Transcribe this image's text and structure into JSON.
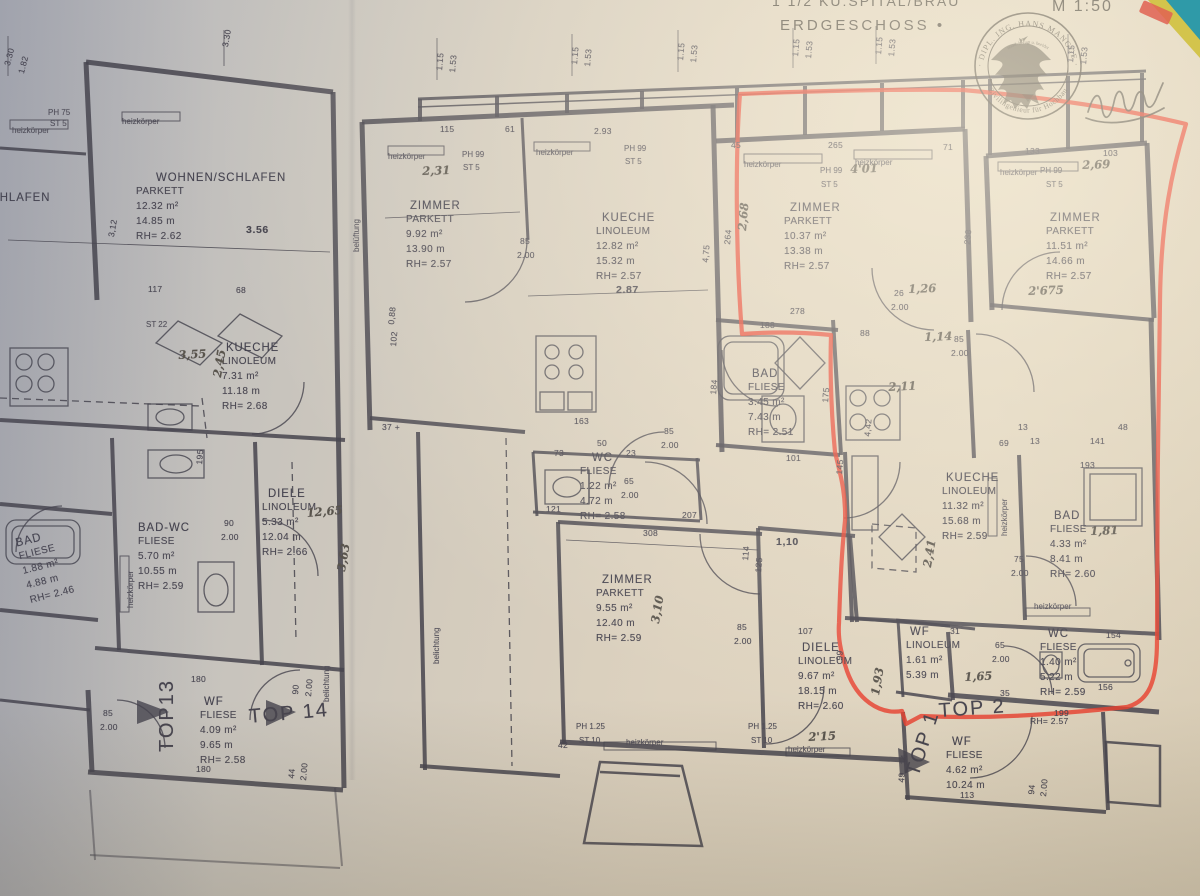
{
  "paper": {
    "background": "#d8cec0",
    "line_color": "#46444e",
    "pencil_color": "#59544c",
    "marker_color": "#e8402e"
  },
  "header": {
    "project_line": "1 1/2 KU:SPITAL/BRAU",
    "floor_line": "ERDGESCHOSS •",
    "scale": "M 1:50"
  },
  "stamp": {
    "arc_top": "· DIPL. ING. HANS MANGGE ·",
    "arc_inner": "staatl. befugt u. beeidet",
    "arc_bottom": "Zivilingenieur für Hochbau"
  },
  "rooms": [
    {
      "name": "WOHNEN/SCHLAFEN",
      "flooring": "PARKETT",
      "area": "12.32 m²",
      "perimeter": "14.85 m",
      "height": "RH= 2.62",
      "x": 136,
      "y": 170,
      "dx": 20
    },
    {
      "name": "SCHLAFEN",
      "x": -18,
      "y": 190
    },
    {
      "name": "ZIMMER",
      "flooring": "PARKETT",
      "area": "9.92 m²",
      "perimeter": "13.90 m",
      "height": "RH= 2.57",
      "x": 406,
      "y": 198,
      "dx": 4
    },
    {
      "name": "KUECHE",
      "flooring": "LINOLEUM",
      "area": "12.82 m²",
      "perimeter": "15.32 m",
      "height": "RH= 2.57",
      "x": 596,
      "y": 210,
      "dx": 6
    },
    {
      "name": "ZIMMER",
      "flooring": "PARKETT",
      "area": "10.37 m²",
      "perimeter": "13.38 m",
      "height": "RH= 2.57",
      "x": 784,
      "y": 200,
      "dx": 6
    },
    {
      "name": "ZIMMER",
      "flooring": "PARKETT",
      "area": "11.51 m²",
      "perimeter": "14.66 m",
      "height": "RH= 2.57",
      "x": 1046,
      "y": 210,
      "dx": 4
    },
    {
      "name": "KUECHE",
      "flooring": "LINOLEUM",
      "area": "7.31 m²",
      "perimeter": "11.18 m",
      "height": "RH= 2.68",
      "x": 222,
      "y": 340,
      "dx": 4
    },
    {
      "name": "BAD-WC",
      "flooring": "FLIESE",
      "area": "5.70 m²",
      "perimeter": "10.55 m",
      "height": "RH= 2.59",
      "x": 138,
      "y": 520
    },
    {
      "name": "DIELE",
      "flooring": "LINOLEUM",
      "area": "5.33 m²",
      "perimeter": "12.04 m",
      "height": "RH= 2.66",
      "x": 262,
      "y": 486,
      "dx": 6
    },
    {
      "name": "BAD",
      "flooring": "FLIESE",
      "area": "1.88 m²",
      "perimeter": "4.88 m",
      "height": "RH= 2.46",
      "x": 14,
      "y": 536,
      "rot": -14
    },
    {
      "name": "WC",
      "flooring": "FLIESE",
      "area": "1.22 m²",
      "perimeter": "4.72 m",
      "height": "RH= 2.58",
      "x": 580,
      "y": 450,
      "dx": 12
    },
    {
      "name": "ZIMMER",
      "flooring": "PARKETT",
      "area": "9.55 m²",
      "perimeter": "12.40 m",
      "height": "RH= 2.59",
      "x": 596,
      "y": 572,
      "dx": 6
    },
    {
      "name": "BAD",
      "flooring": "FLIESE",
      "area": "3.45 m²",
      "perimeter": "7.43 m",
      "height": "RH= 2.51",
      "x": 748,
      "y": 366,
      "dx": 4
    },
    {
      "name": "KUECHE",
      "flooring": "LINOLEUM",
      "area": "11.32 m²",
      "perimeter": "15.68 m",
      "height": "RH= 2.59",
      "x": 942,
      "y": 470,
      "dx": 4
    },
    {
      "name": "BAD",
      "flooring": "FLIESE",
      "area": "4.33 m²",
      "perimeter": "8.41 m",
      "height": "RH= 2.60",
      "x": 1050,
      "y": 508,
      "dx": 4
    },
    {
      "name": "WC",
      "flooring": "FLIESE",
      "area": "1.40 m²",
      "perimeter": "5.22 m",
      "height": "RH= 2.59",
      "x": 1040,
      "y": 626,
      "dx": 8
    },
    {
      "name": "DIELE",
      "flooring": "LINOLEUM",
      "area": "9.67 m²",
      "perimeter": "18.15 m",
      "height": "RH= 2.60",
      "x": 798,
      "y": 640,
      "dx": 4
    },
    {
      "name": "WF",
      "flooring": "LINOLEUM",
      "area": "1.61 m²",
      "perimeter": "5.39 m",
      "x": 906,
      "y": 624,
      "dx": 4
    },
    {
      "name": "WF",
      "flooring": "FLIESE",
      "area": "4.09 m²",
      "perimeter": "9.65 m",
      "height": "RH= 2.58",
      "x": 200,
      "y": 694,
      "dx": 4
    },
    {
      "name": "WF",
      "flooring": "FLIESE",
      "area": "4.62 m²",
      "perimeter": "10.24 m",
      "x": 946,
      "y": 734,
      "dx": 6
    }
  ],
  "tops": [
    {
      "t": "TOP13",
      "x": 156,
      "y": 752,
      "r": -90
    },
    {
      "t": "TOP 14",
      "x": 248,
      "y": 706,
      "r": -5
    },
    {
      "t": "TOP 1",
      "x": 902,
      "y": 772,
      "r": -72
    },
    {
      "t": "TOP 2",
      "x": 938,
      "y": 700,
      "r": -4
    }
  ],
  "notes": [
    {
      "t": "4'01",
      "x": 850,
      "y": 162,
      "r": -2
    },
    {
      "t": "2,69",
      "x": 1082,
      "y": 158,
      "r": -2
    },
    {
      "t": "2'675",
      "x": 1028,
      "y": 284,
      "r": -2
    },
    {
      "t": "2,68",
      "x": 735,
      "y": 230,
      "r": -85
    },
    {
      "t": "3,55",
      "x": 178,
      "y": 348,
      "r": -3
    },
    {
      "t": "2,45",
      "x": 210,
      "y": 376,
      "r": -80
    },
    {
      "t": "12,65",
      "x": 306,
      "y": 506,
      "r": -5
    },
    {
      "t": "3,63",
      "x": 334,
      "y": 570,
      "r": -80
    },
    {
      "t": "2,11",
      "x": 888,
      "y": 380,
      "r": -3
    },
    {
      "t": "2,41",
      "x": 920,
      "y": 566,
      "r": -80
    },
    {
      "t": "1,81",
      "x": 1090,
      "y": 524,
      "r": -2
    },
    {
      "t": "1,65",
      "x": 964,
      "y": 670,
      "r": -3
    },
    {
      "t": "1,93",
      "x": 868,
      "y": 694,
      "r": -80
    },
    {
      "t": "3,10",
      "x": 648,
      "y": 622,
      "r": -80
    },
    {
      "t": "2'15",
      "x": 808,
      "y": 730,
      "r": -3
    },
    {
      "t": "1,26",
      "x": 908,
      "y": 282,
      "r": -2
    },
    {
      "t": "1,14",
      "x": 924,
      "y": 330,
      "r": -2
    },
    {
      "t": "2,31",
      "x": 422,
      "y": 164,
      "r": -2
    }
  ],
  "dims": [
    {
      "t": "3.30",
      "x": 2,
      "y": 64,
      "r": -75
    },
    {
      "t": "1.82",
      "x": 16,
      "y": 72,
      "r": -75
    },
    {
      "t": "3.30",
      "x": 220,
      "y": 46,
      "r": -80
    },
    {
      "t": "1.15",
      "x": 434,
      "y": 70,
      "r": -85
    },
    {
      "t": "1.53",
      "x": 447,
      "y": 72,
      "r": -85
    },
    {
      "t": "1.15",
      "x": 569,
      "y": 64,
      "r": -85
    },
    {
      "t": "1.53",
      "x": 582,
      "y": 66,
      "r": -85
    },
    {
      "t": "1.15",
      "x": 675,
      "y": 60,
      "r": -85
    },
    {
      "t": "1.53",
      "x": 688,
      "y": 62,
      "r": -85
    },
    {
      "t": "1.15",
      "x": 790,
      "y": 56,
      "r": -85
    },
    {
      "t": "1.53",
      "x": 803,
      "y": 58,
      "r": -85
    },
    {
      "t": "1.15",
      "x": 873,
      "y": 54,
      "r": -85
    },
    {
      "t": "1.53",
      "x": 886,
      "y": 56,
      "r": -85
    },
    {
      "t": "1.15",
      "x": 1065,
      "y": 62,
      "r": -85
    },
    {
      "t": "1.53",
      "x": 1078,
      "y": 64,
      "r": -85
    },
    {
      "t": "115",
      "x": 440,
      "y": 124
    },
    {
      "t": "61",
      "x": 505,
      "y": 124
    },
    {
      "t": "2.93",
      "x": 594,
      "y": 126
    },
    {
      "t": "45",
      "x": 731,
      "y": 140
    },
    {
      "t": "265",
      "x": 828,
      "y": 140
    },
    {
      "t": "71",
      "x": 943,
      "y": 142
    },
    {
      "t": "133",
      "x": 1025,
      "y": 146
    },
    {
      "t": "103",
      "x": 1103,
      "y": 148
    },
    {
      "t": "PH 75",
      "x": 48,
      "y": 108,
      "k": "s"
    },
    {
      "t": "ST 5",
      "x": 50,
      "y": 119,
      "k": "s"
    },
    {
      "t": "heizkörper",
      "x": 12,
      "y": 126,
      "k": "s"
    },
    {
      "t": "heizkörper",
      "x": 122,
      "y": 117,
      "k": "s"
    },
    {
      "t": "heizkörper",
      "x": 388,
      "y": 152,
      "k": "s"
    },
    {
      "t": "heizkörper",
      "x": 536,
      "y": 148,
      "k": "s"
    },
    {
      "t": "heizkörper",
      "x": 744,
      "y": 160,
      "k": "s"
    },
    {
      "t": "heizkörper",
      "x": 855,
      "y": 158,
      "k": "s"
    },
    {
      "t": "heizkörper",
      "x": 1000,
      "y": 168,
      "k": "s"
    },
    {
      "t": "heizkörper",
      "x": 626,
      "y": 738,
      "k": "s"
    },
    {
      "t": "heizkörper",
      "x": 788,
      "y": 745,
      "k": "s"
    },
    {
      "t": "heizkörper",
      "x": 1034,
      "y": 602,
      "k": "s"
    },
    {
      "t": "heizkörper",
      "x": 126,
      "y": 608,
      "r": -90,
      "k": "s"
    },
    {
      "t": "heizkörper",
      "x": 1000,
      "y": 536,
      "r": -90,
      "k": "s"
    },
    {
      "t": "belüftung",
      "x": 352,
      "y": 252,
      "r": -90,
      "k": "s"
    },
    {
      "t": "belichtung",
      "x": 432,
      "y": 664,
      "r": -90,
      "k": "s"
    },
    {
      "t": "belichtung",
      "x": 322,
      "y": 702,
      "r": -90,
      "k": "s"
    },
    {
      "t": "PH 99",
      "x": 462,
      "y": 150,
      "k": "s"
    },
    {
      "t": "ST 5",
      "x": 463,
      "y": 163,
      "k": "s"
    },
    {
      "t": "PH 99",
      "x": 624,
      "y": 144,
      "k": "s"
    },
    {
      "t": "ST 5",
      "x": 625,
      "y": 157,
      "k": "s"
    },
    {
      "t": "PH 99",
      "x": 820,
      "y": 166,
      "k": "s"
    },
    {
      "t": "ST 5",
      "x": 821,
      "y": 180,
      "k": "s"
    },
    {
      "t": "PH 99",
      "x": 1040,
      "y": 166,
      "k": "s"
    },
    {
      "t": "ST 5",
      "x": 1046,
      "y": 180,
      "k": "s"
    },
    {
      "t": "PH 1.25",
      "x": 576,
      "y": 722,
      "k": "s"
    },
    {
      "t": "ST 10",
      "x": 579,
      "y": 736,
      "k": "s"
    },
    {
      "t": "PH 1.25",
      "x": 748,
      "y": 722,
      "k": "s"
    },
    {
      "t": "ST 10",
      "x": 751,
      "y": 736,
      "k": "s"
    },
    {
      "t": "ST 22",
      "x": 146,
      "y": 320,
      "k": "s"
    },
    {
      "t": "42",
      "x": 558,
      "y": 740
    },
    {
      "t": "3.56",
      "x": 246,
      "y": 224,
      "k": "b"
    },
    {
      "t": "2.87",
      "x": 616,
      "y": 284,
      "k": "b"
    },
    {
      "t": "1,10",
      "x": 776,
      "y": 536,
      "k": "b"
    },
    {
      "t": "85",
      "x": 520,
      "y": 236
    },
    {
      "t": "2.00",
      "x": 517,
      "y": 250
    },
    {
      "t": "85",
      "x": 664,
      "y": 426
    },
    {
      "t": "2.00",
      "x": 661,
      "y": 440
    },
    {
      "t": "65",
      "x": 624,
      "y": 476
    },
    {
      "t": "2.00",
      "x": 621,
      "y": 490
    },
    {
      "t": "85",
      "x": 954,
      "y": 334
    },
    {
      "t": "2.00",
      "x": 951,
      "y": 348
    },
    {
      "t": "85",
      "x": 737,
      "y": 622
    },
    {
      "t": "2.00",
      "x": 734,
      "y": 636
    },
    {
      "t": "85",
      "x": 103,
      "y": 708
    },
    {
      "t": "2.00",
      "x": 100,
      "y": 722
    },
    {
      "t": "90",
      "x": 224,
      "y": 518
    },
    {
      "t": "2.00",
      "x": 221,
      "y": 532
    },
    {
      "t": "90",
      "x": 290,
      "y": 694,
      "r": -85
    },
    {
      "t": "2.00",
      "x": 303,
      "y": 696,
      "r": -85
    },
    {
      "t": "75",
      "x": 1014,
      "y": 554
    },
    {
      "t": "2.00",
      "x": 1011,
      "y": 568
    },
    {
      "t": "65",
      "x": 995,
      "y": 640
    },
    {
      "t": "2.00",
      "x": 992,
      "y": 654
    },
    {
      "t": "44",
      "x": 286,
      "y": 778,
      "r": -85
    },
    {
      "t": "2.00",
      "x": 298,
      "y": 780,
      "r": -85
    },
    {
      "t": "94",
      "x": 1026,
      "y": 794,
      "r": -85
    },
    {
      "t": "2.00",
      "x": 1038,
      "y": 796,
      "r": -85
    },
    {
      "t": "278",
      "x": 790,
      "y": 306
    },
    {
      "t": "188",
      "x": 760,
      "y": 320
    },
    {
      "t": "88",
      "x": 860,
      "y": 328
    },
    {
      "t": "26",
      "x": 894,
      "y": 288
    },
    {
      "t": "2.00",
      "x": 891,
      "y": 302
    },
    {
      "t": "238",
      "x": 962,
      "y": 244,
      "r": -85
    },
    {
      "t": "264",
      "x": 722,
      "y": 244,
      "r": -85
    },
    {
      "t": "4,75",
      "x": 700,
      "y": 262,
      "r": -85
    },
    {
      "t": "0,88",
      "x": 386,
      "y": 324,
      "r": -85
    },
    {
      "t": "102",
      "x": 388,
      "y": 346,
      "r": -85
    },
    {
      "t": "3,12",
      "x": 106,
      "y": 236,
      "r": -80
    },
    {
      "t": "37 +",
      "x": 382,
      "y": 422
    },
    {
      "t": "163",
      "x": 574,
      "y": 416
    },
    {
      "t": "50",
      "x": 597,
      "y": 438
    },
    {
      "t": "73",
      "x": 554,
      "y": 448
    },
    {
      "t": "23",
      "x": 626,
      "y": 448
    },
    {
      "t": "121",
      "x": 546,
      "y": 504
    },
    {
      "t": "207",
      "x": 682,
      "y": 510
    },
    {
      "t": "308",
      "x": 643,
      "y": 528
    },
    {
      "t": "114",
      "x": 740,
      "y": 560,
      "r": -85
    },
    {
      "t": "125",
      "x": 753,
      "y": 572,
      "r": -85
    },
    {
      "t": "117",
      "x": 148,
      "y": 284
    },
    {
      "t": "68",
      "x": 236,
      "y": 285
    },
    {
      "t": "195",
      "x": 194,
      "y": 464,
      "r": -85
    },
    {
      "t": "184",
      "x": 708,
      "y": 394,
      "r": -85
    },
    {
      "t": "175",
      "x": 820,
      "y": 402,
      "r": -85
    },
    {
      "t": "4,42",
      "x": 862,
      "y": 436,
      "r": -85
    },
    {
      "t": "101",
      "x": 786,
      "y": 453
    },
    {
      "t": "145",
      "x": 834,
      "y": 474,
      "r": -85
    },
    {
      "t": "69",
      "x": 999,
      "y": 438
    },
    {
      "t": "13",
      "x": 1018,
      "y": 422
    },
    {
      "t": "13",
      "x": 1030,
      "y": 436
    },
    {
      "t": "48",
      "x": 1118,
      "y": 422
    },
    {
      "t": "141",
      "x": 1090,
      "y": 436
    },
    {
      "t": "193",
      "x": 1080,
      "y": 460
    },
    {
      "t": "31",
      "x": 950,
      "y": 626
    },
    {
      "t": "35",
      "x": 1000,
      "y": 688
    },
    {
      "t": "154",
      "x": 1106,
      "y": 630
    },
    {
      "t": "156",
      "x": 1098,
      "y": 682
    },
    {
      "t": "199",
      "x": 1054,
      "y": 708
    },
    {
      "t": "107",
      "x": 798,
      "y": 626
    },
    {
      "t": "99",
      "x": 834,
      "y": 660,
      "r": -85
    },
    {
      "t": "180",
      "x": 191,
      "y": 674
    },
    {
      "t": "180",
      "x": 196,
      "y": 764
    },
    {
      "t": "113",
      "x": 960,
      "y": 790
    },
    {
      "t": "14",
      "x": 898,
      "y": 764,
      "r": -85
    },
    {
      "t": "49",
      "x": 896,
      "y": 782,
      "r": -85
    },
    {
      "t": "RH= 2.57",
      "x": 1030,
      "y": 716
    }
  ]
}
